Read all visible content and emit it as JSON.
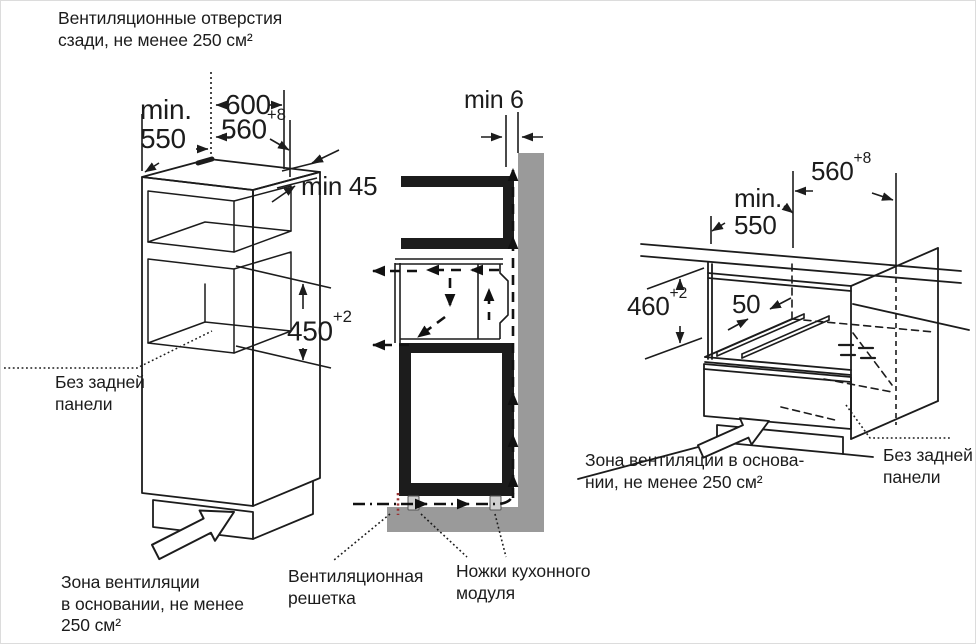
{
  "notes": {
    "vent_back": "Вентиляционные отверстия\nсзади, не менее 250 см²",
    "no_back_left": "Без задней\nпанели",
    "vent_zone_left": "Зона вентиляции\nв основании, не менее\n250 см²",
    "vent_grille": "Вентиляционная\nрешетка",
    "module_feet": "Ножки кухонного\nмодуля",
    "vent_zone_right": "Зона вентиляции в основа-\nнии, не менее 250 см²",
    "no_back_right": "Без задней\nпанели"
  },
  "dimensions": {
    "left_figure": {
      "depth": "min.\n550",
      "width": "600",
      "niche_width": {
        "value": "560",
        "tol": "+8"
      },
      "top_rear_gap": "min 45",
      "niche_height": {
        "value": "450",
        "tol": "+2"
      }
    },
    "middle_figure": {
      "front_gap": "min 6"
    },
    "right_figure": {
      "niche_width": {
        "value": "560",
        "tol": "+8"
      },
      "depth": "min.\n550",
      "niche_height": {
        "value": "460",
        "tol": "+2"
      },
      "rail_spacing": "50"
    }
  },
  "colors": {
    "line": "#1c1c1c",
    "wall_gray": "#9a9a9a",
    "feet_gray": "#cfcfcf",
    "grille_red": "#993333"
  }
}
